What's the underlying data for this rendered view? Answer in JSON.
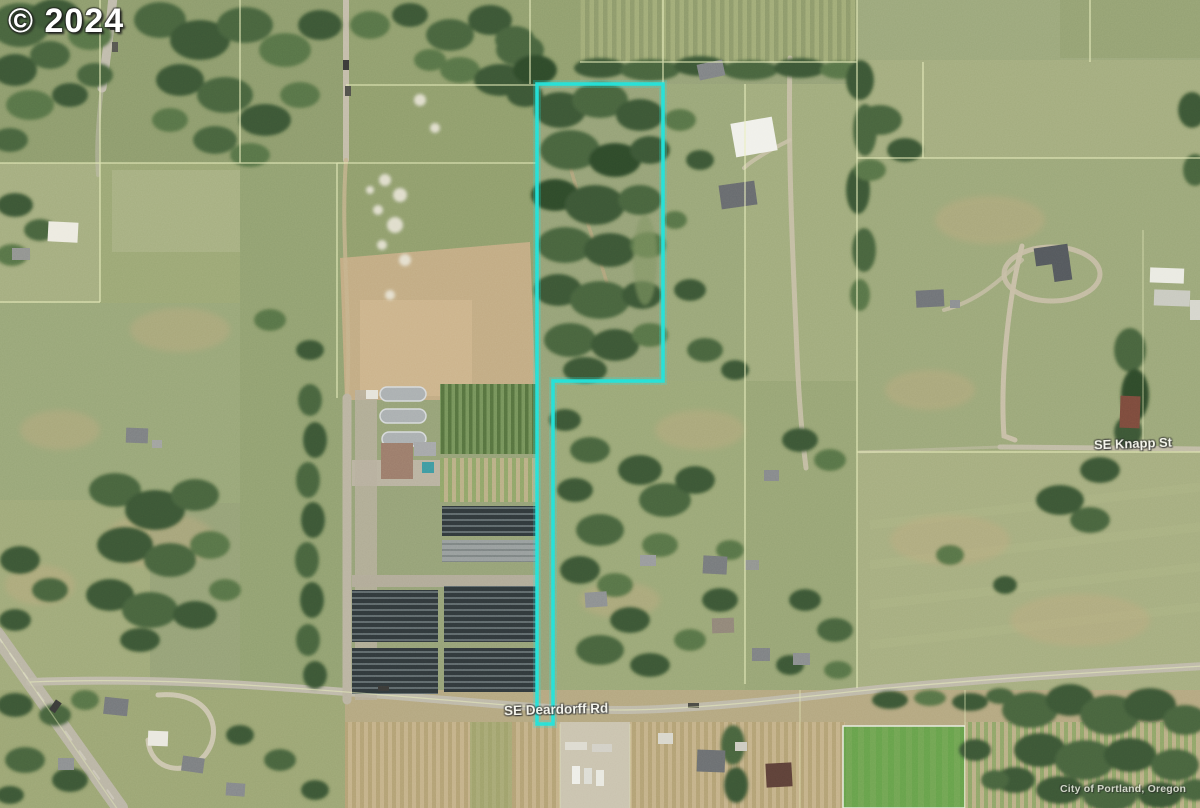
{
  "map": {
    "copyright": "© 2024",
    "imagery_credit": "City of Portland, Oregon",
    "street_labels": [
      {
        "name": "SE Knapp St"
      },
      {
        "name": "SE Deardorff Rd"
      }
    ],
    "highlight_color": "#22E3DA",
    "parcel_line_color": "#E9EFBC"
  }
}
